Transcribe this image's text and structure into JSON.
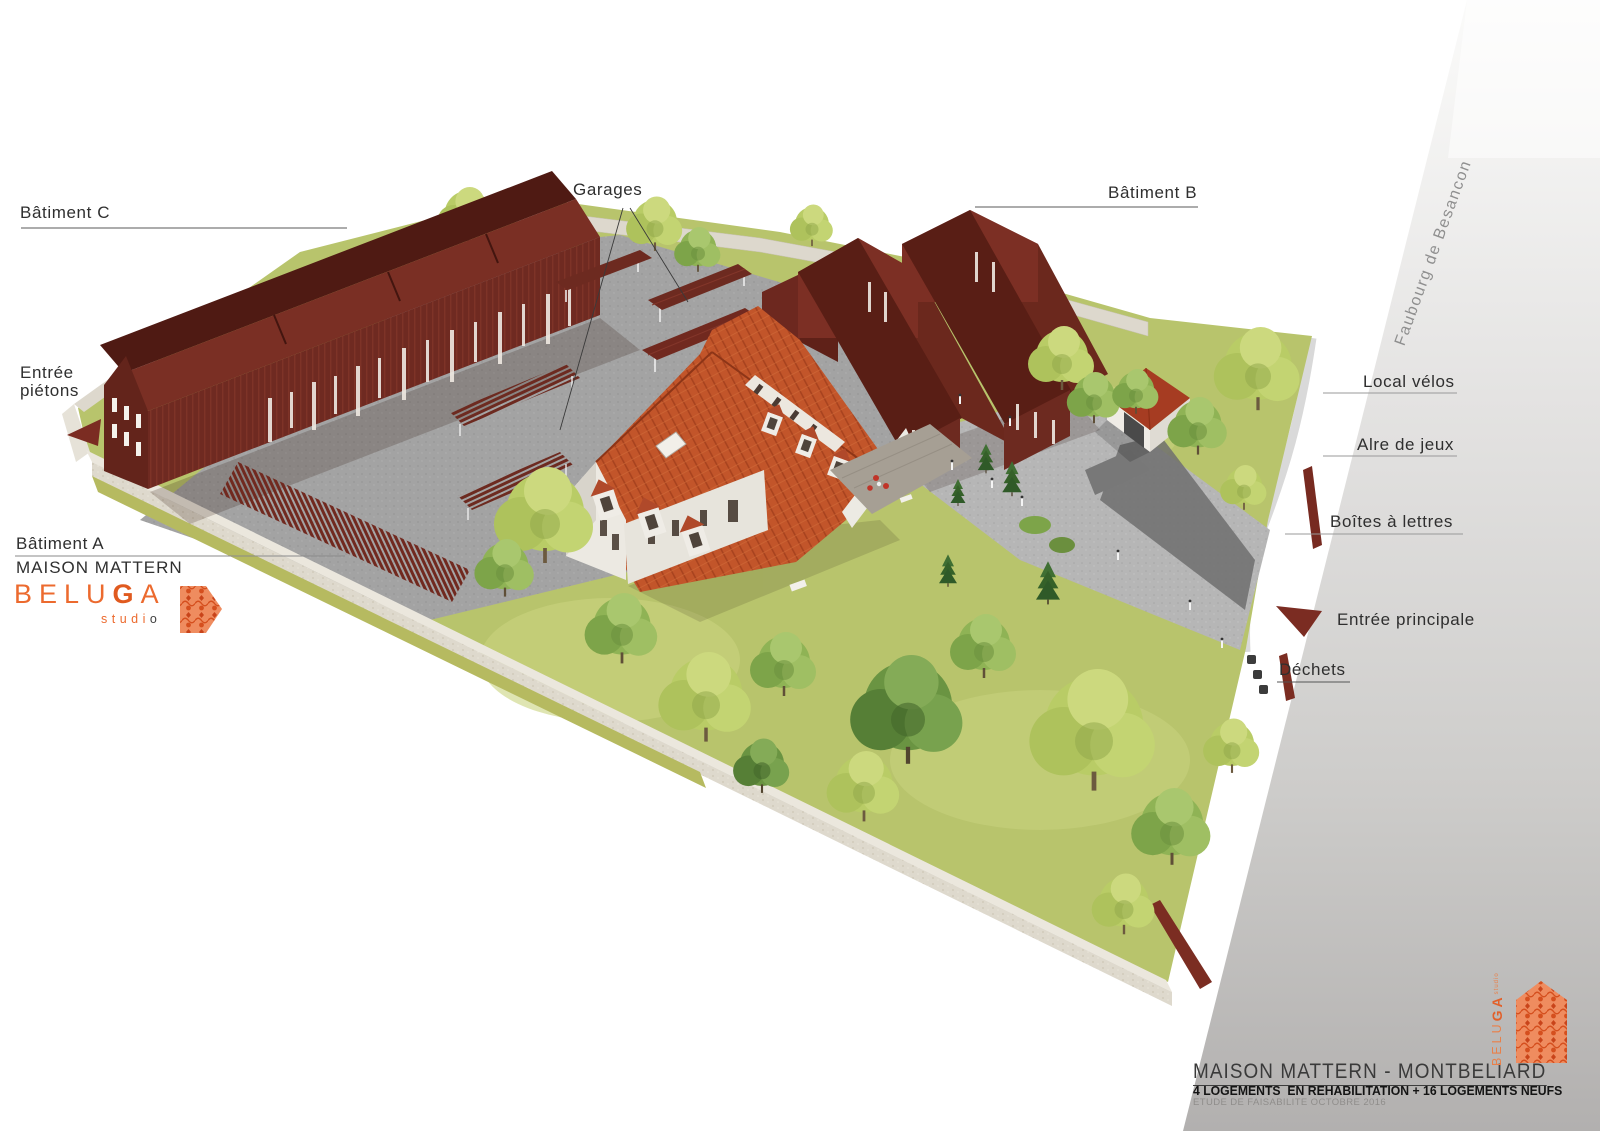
{
  "annotations": {
    "batiment_c": "Bâtiment C",
    "garages": "Garages",
    "batiment_b": "Bâtiment B",
    "entree_pietons": "Entrée piétons",
    "batiment_a": "Bâtiment A",
    "maison_mattern": "MAISON MATTERN",
    "local_velos": "Local vélos",
    "aire_de_jeux": "Alre de jeux",
    "boites_a_lettres": "Boîtes à lettres",
    "entree_principale": "Entrée principale",
    "dechets": "Déchets",
    "street_name": "Faubourg de Besancon"
  },
  "studio_logo": {
    "word_start": "BELU",
    "word_accent": "G",
    "word_end": "A",
    "sub_start": "studi",
    "sub_end": "o"
  },
  "title_block": {
    "title": "MAISON MATTERN - MONTBELIARD",
    "subtitle": "4 LOGEMENTS  EN REHABILITATION + 16 LOGEMENTS NEUFS",
    "note": "ETUDE DE FAISABILITE OCTOBRE 2016"
  },
  "colors": {
    "accent_orange": "#EC6A2E",
    "building_dark_red": "#6E2A20",
    "roof_terracotta": "#C2552A",
    "arrow_red": "#7B2C22",
    "label_text": "#2F2F2F",
    "street_gray": "#B4B2B1",
    "lawn_green": "#B8C46C"
  }
}
